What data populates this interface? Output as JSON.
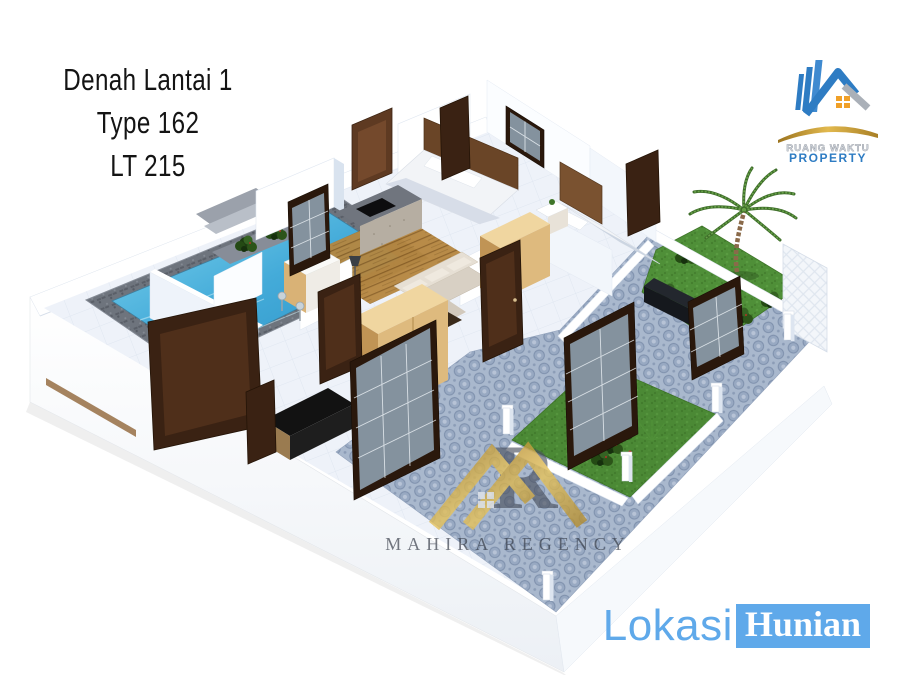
{
  "canvas": {
    "width": 900,
    "height": 675,
    "background": "#ffffff"
  },
  "title_block": {
    "line1": "Denah Lantai 1",
    "line2": "Type 162",
    "line3": "LT 215"
  },
  "developer_logo": {
    "name": "RUANG WAKTU",
    "tagline": "PROPERTY"
  },
  "watermark": {
    "monogram": "R",
    "brand": "MAHIRA REGENCY"
  },
  "location_badge": {
    "word1": "Lokasi",
    "word2": "Hunian"
  },
  "floorplan": {
    "elements": [
      "swimming-pool",
      "stone-pool-deck",
      "pool-steps",
      "planter-box",
      "kitchen-bar",
      "dining-wood-floor",
      "living-room-sofa",
      "wardrobes",
      "bedroom-beds",
      "wooden-doors",
      "glass-doors",
      "upper-garden",
      "palm-tree",
      "lower-garden",
      "garden-shrubs",
      "hexagon-paving",
      "garden-pillars",
      "perimeter-walls",
      "lattice-garden-wall"
    ],
    "colors": {
      "pool_water": "#3fa6d8",
      "grass": "#4f8f38",
      "paving_tile": "#a9b8cd",
      "door_wood": "#3a2213",
      "cabinet_wood": "#deba7e",
      "wall_white": "#ffffff",
      "wall_shadow": "#d9e3ef",
      "stone_deck": "#6e747d",
      "gold": "#c79a3a",
      "logo_blue": "#2e7cc3",
      "brand_blue": "#5fa9ea",
      "text_black": "#141414"
    }
  }
}
